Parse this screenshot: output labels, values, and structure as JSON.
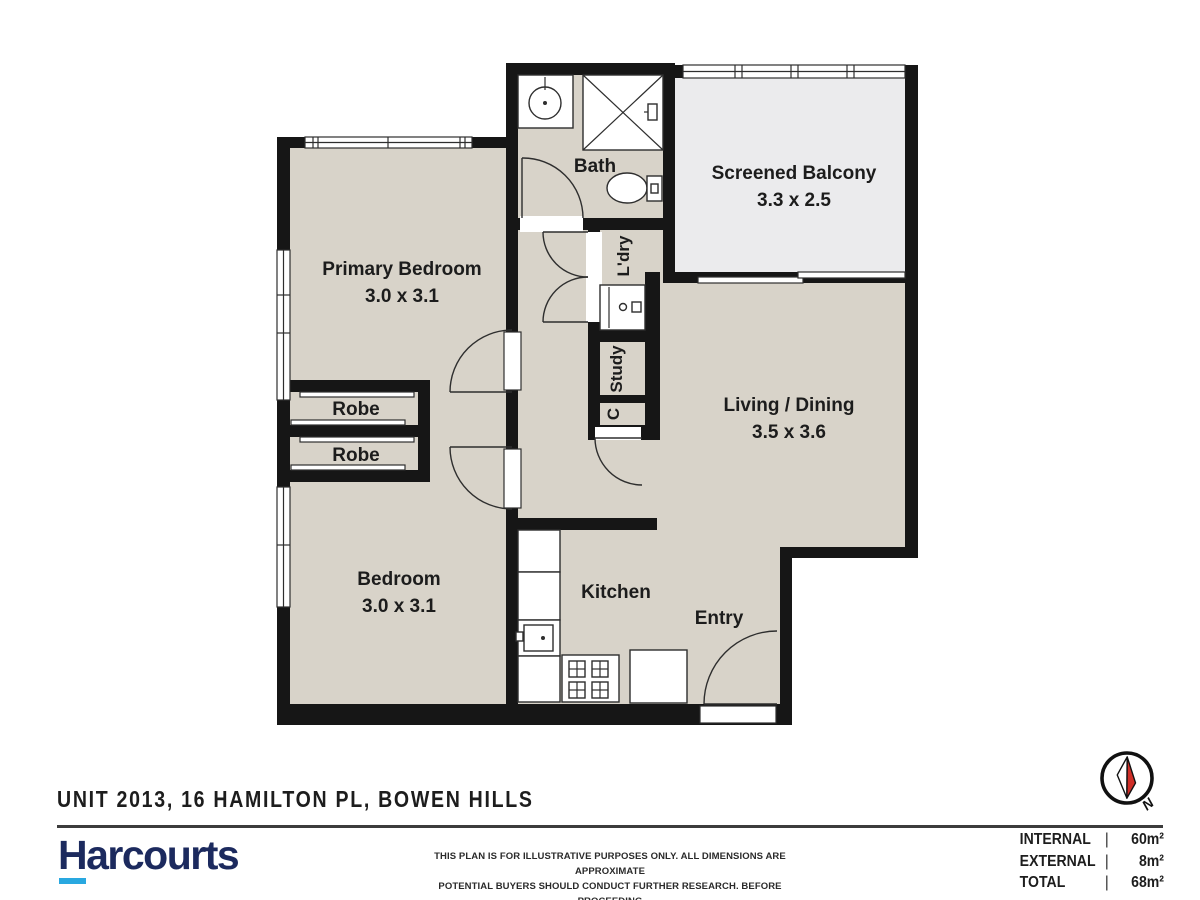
{
  "plan": {
    "rooms": {
      "bath": {
        "label": "Bath"
      },
      "balcony": {
        "label": "Screened Balcony",
        "dims": "3.3 x 2.5"
      },
      "primary_bedroom": {
        "label": "Primary Bedroom",
        "dims": "3.0 x 3.1"
      },
      "robe1": {
        "label": "Robe"
      },
      "robe2": {
        "label": "Robe"
      },
      "bedroom": {
        "label": "Bedroom",
        "dims": "3.0 x 3.1"
      },
      "living_dining": {
        "label": "Living / Dining",
        "dims": "3.5 x 3.6"
      },
      "kitchen": {
        "label": "Kitchen"
      },
      "entry": {
        "label": "Entry"
      },
      "laundry": {
        "label": "L'dry"
      },
      "study": {
        "label": "Study"
      },
      "cupboard": {
        "label": "C"
      }
    },
    "colors": {
      "floor": "#d8d3c9",
      "balcony_floor": "#ebebed",
      "wall": "#161616"
    }
  },
  "footer": {
    "title": "UNIT 2013, 16 HAMILTON PL, BOWEN HILLS",
    "brand": {
      "name": "Harcourts",
      "navy": "#1c2a5e",
      "cyan": "#29a8e0"
    },
    "disclaimer_line1": "THIS PLAN IS FOR ILLUSTRATIVE PURPOSES ONLY.  ALL DIMENSIONS ARE APPROXIMATE",
    "disclaimer_line2": "POTENTIAL BUYERS SHOULD CONDUCT  FURTHER RESEARCH. BEFORE PROCEEDING",
    "areas": [
      {
        "label": "INTERNAL",
        "sep": "|",
        "value": "60m²"
      },
      {
        "label": "EXTERNAL",
        "sep": "|",
        "value": "8m²"
      },
      {
        "label": "TOTAL",
        "sep": "|",
        "value": "68m²"
      }
    ],
    "compass": {
      "label": "N",
      "needle_red": "#cf2e27"
    }
  }
}
